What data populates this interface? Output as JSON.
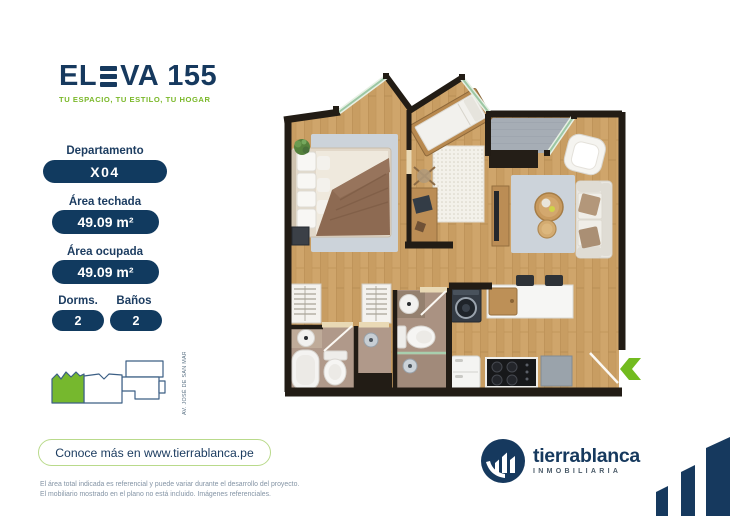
{
  "logo": {
    "part1": "EL",
    "part2": "VA",
    "number": "155",
    "tagline": "TU ESPACIO, TU ESTILO, TU HOGAR"
  },
  "sidebar": {
    "department_label": "Departamento",
    "department_value": "X04",
    "covered_area_label": "Área techada",
    "covered_area_value": "49.09 m²",
    "occupied_area_label": "Área ocupada",
    "occupied_area_value": "49.09 m²",
    "bedrooms_label": "Dorms.",
    "bedrooms_value": "2",
    "bathrooms_label": "Baños",
    "bathrooms_value": "2",
    "keyplan_street": "AV. JOSÉ DE SAN MARTÍN"
  },
  "cta": {
    "label": "Conoce más en www.tierrablanca.pe"
  },
  "disclaimer": {
    "line1": "El área total indicada es referencial y puede variar durante el desarrollo del proyecto.",
    "line2": "El mobiliario mostrado en el plano no está incluido. Imágenes referenciales."
  },
  "brand": {
    "name": "tierrablanca",
    "subtitle": "INMOBILIARIA"
  },
  "colors": {
    "navy": "#16395e",
    "green": "#76b82e",
    "green_border": "#b9da8b",
    "wall": "#221c15",
    "wood": "#cda269",
    "terrace_gray": "#a6adb5",
    "rug_blue": "#ccd3da",
    "bath_floor": "#b0998a",
    "disclaimer_text": "#8494a5"
  }
}
